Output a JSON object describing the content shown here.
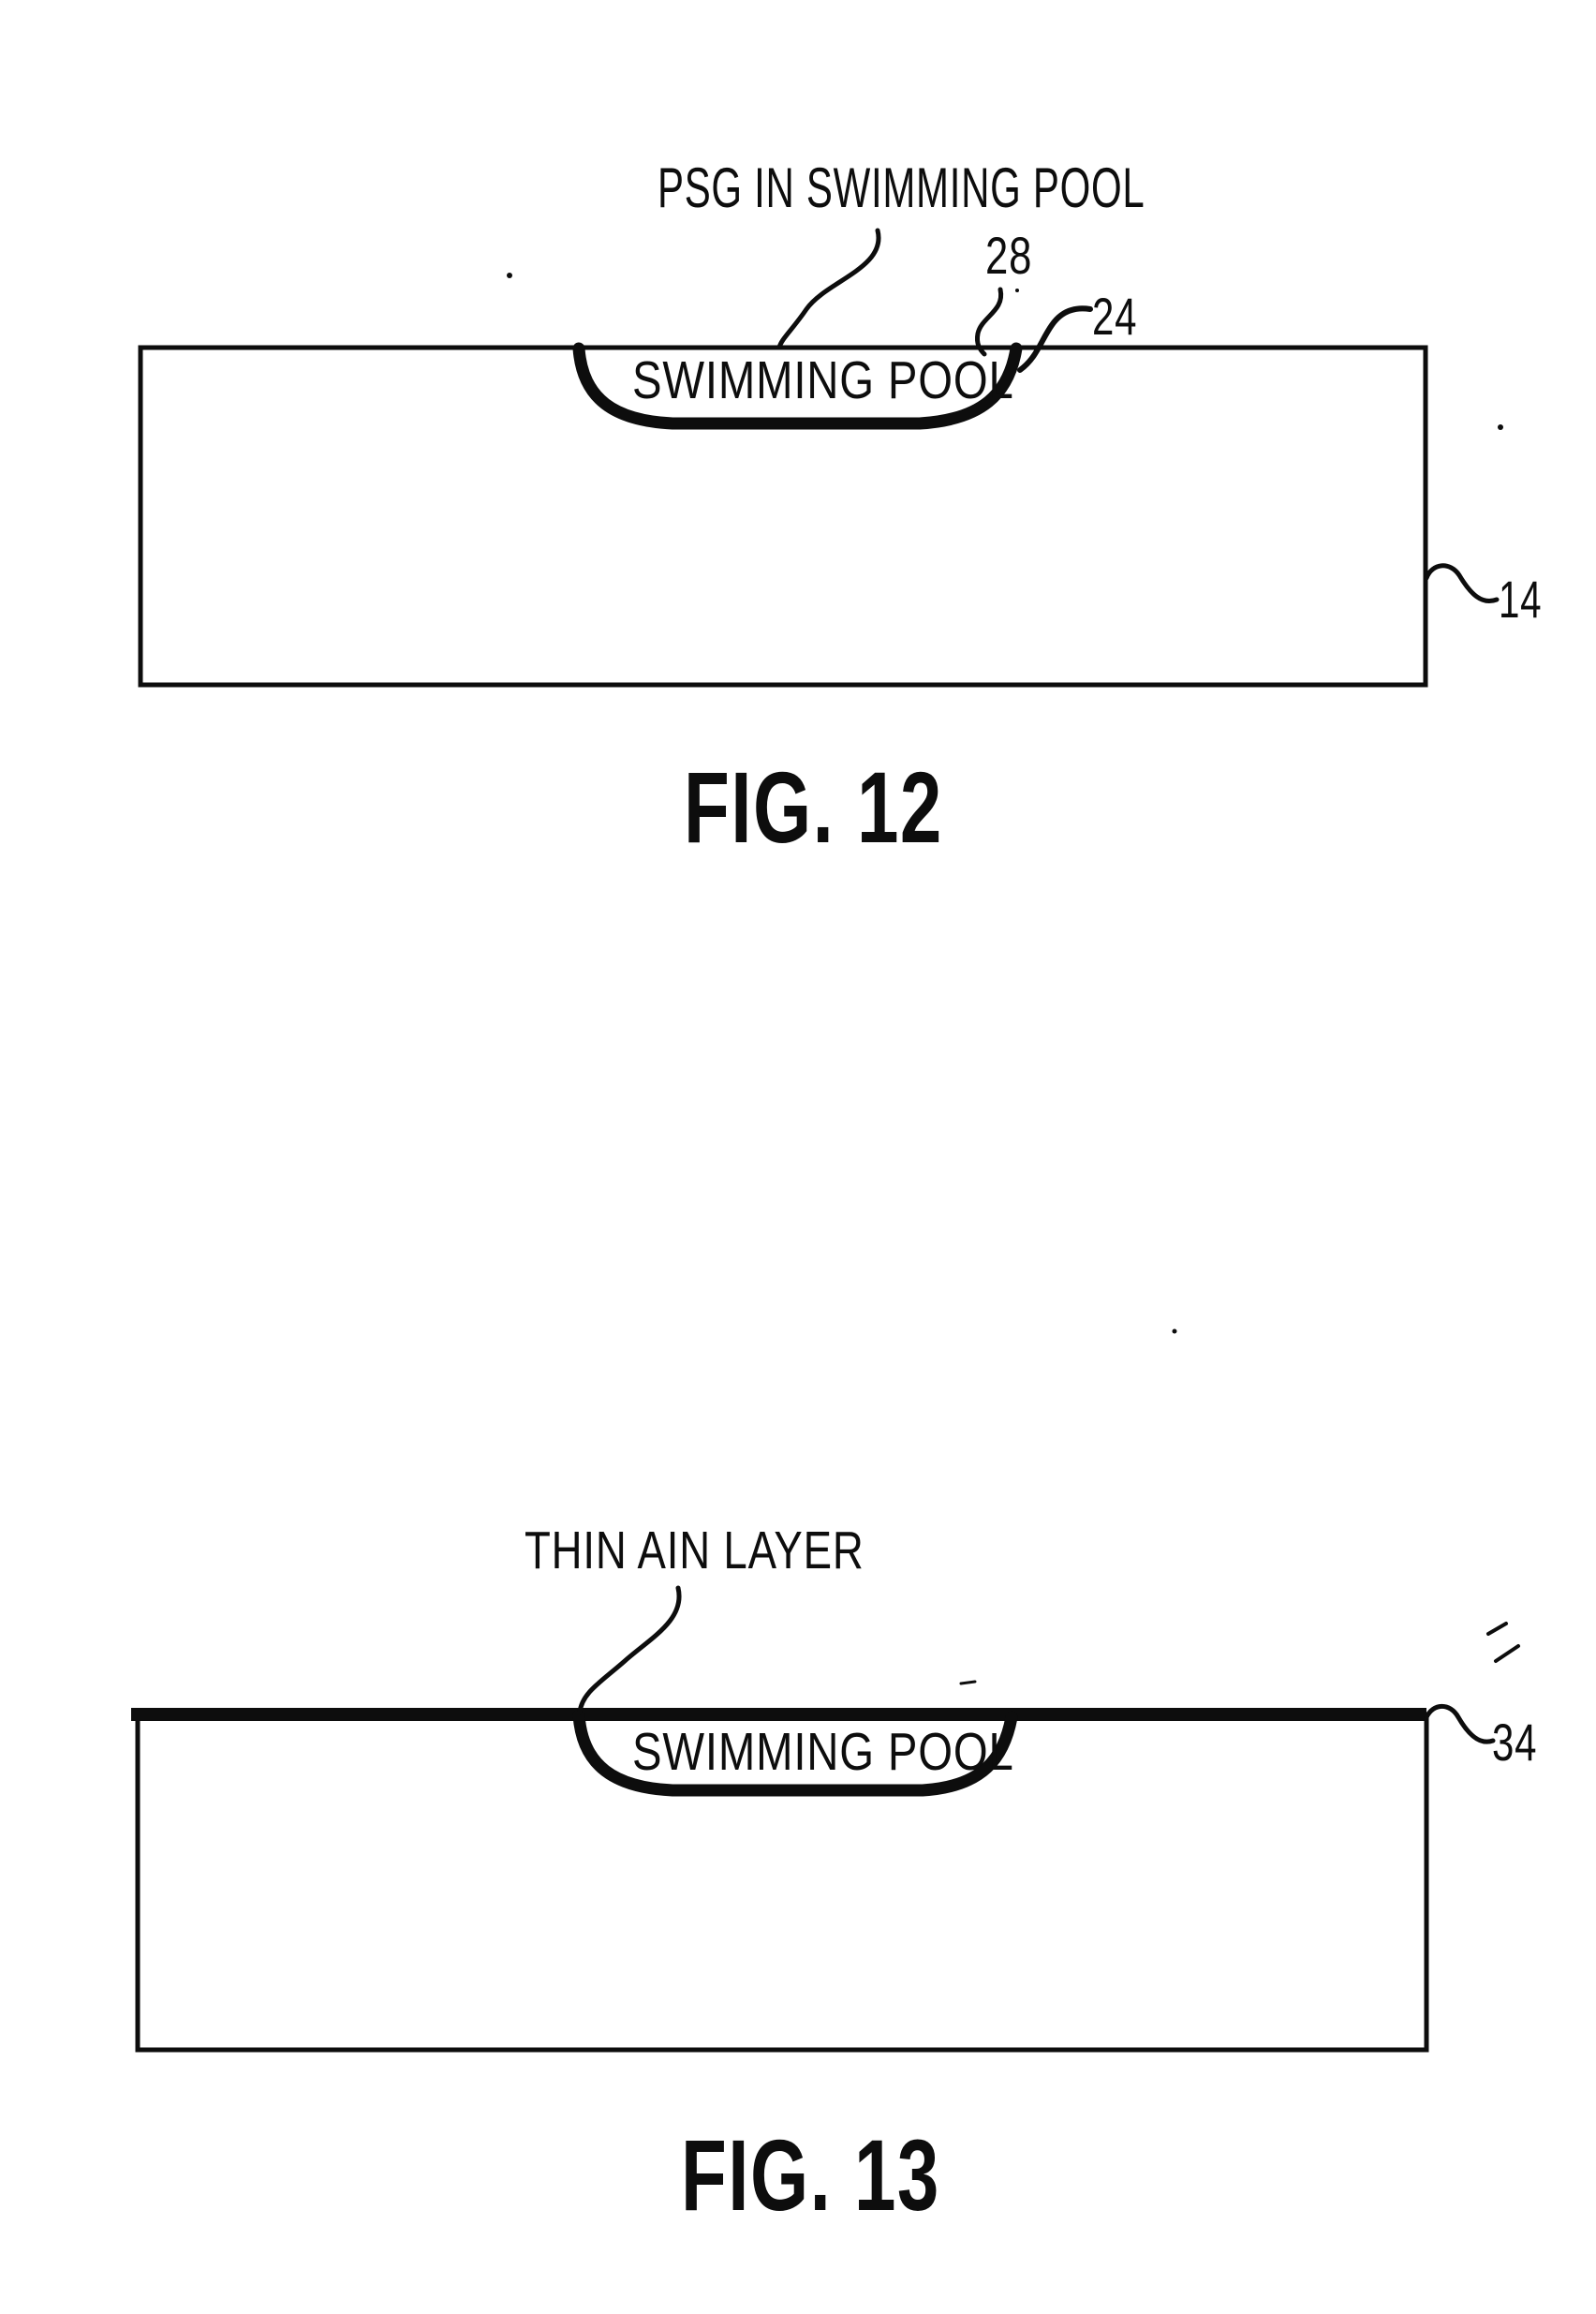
{
  "document": {
    "kind": "patent-figure-page",
    "ink_color": "#0d0d0d",
    "background_color": "#ffffff"
  },
  "fig12": {
    "annotation_label": "PSG IN SWIMMING POOL",
    "pool_label": "SWIMMING POOL",
    "ref_28": "28",
    "ref_24": "24",
    "ref_14": "14",
    "caption": "FIG. 12"
  },
  "fig13": {
    "annotation_label": "THIN AIN LAYER",
    "pool_label": "SWIMMING POOL",
    "ref_34": "34",
    "caption": "FIG. 13"
  }
}
